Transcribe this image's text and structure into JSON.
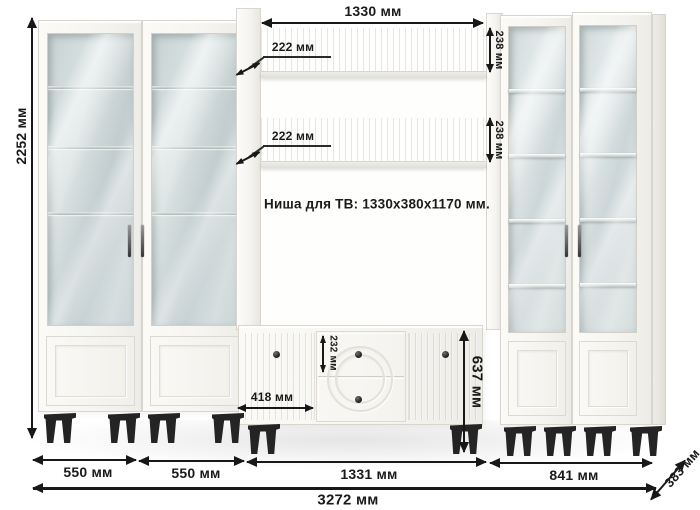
{
  "diagram": {
    "niche_label": "Ниша для ТВ: 1330x380x1170 мм.",
    "labels": {
      "total_height": "2252 мм",
      "niche_width": "1330 мм",
      "shelf1_depth": "222 мм",
      "shelf1_face_height": "238 мм",
      "shelf2_depth": "222 мм",
      "shelf2_face_height": "238 мм",
      "drawer_height": "232 мм",
      "door_width": "418 мм",
      "stand_height": "637 мм",
      "left_cabinet1_width": "550 мм",
      "left_cabinet2_width": "550 мм",
      "center_width": "1331 мм",
      "right_cabinets_width": "841 мм",
      "total_width": "3272 мм",
      "total_depth": "383 мм"
    },
    "colors": {
      "background": "#ffffff",
      "furniture": "#f7f6f3",
      "glass": "#ccd6d7",
      "legs": "#242424",
      "dimension_lines": "#181818"
    }
  }
}
